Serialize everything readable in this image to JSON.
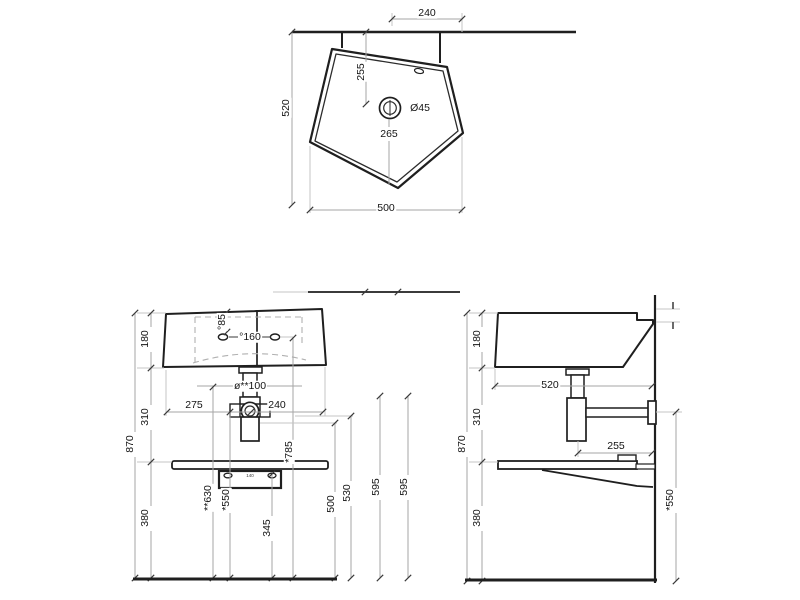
{
  "drawing": {
    "type": "washbasin installation drawing, three orthographic views"
  },
  "top_view": {
    "dims": {
      "offset_240": "240",
      "depth_520": "520",
      "drain_from_wall_255": "255",
      "drain_diameter": "Ø45",
      "drain_to_front_265": "265",
      "width_500": "500"
    }
  },
  "front_view": {
    "dims": {
      "basin_height_180": "180",
      "mid_height_310": "310",
      "overall_height_870": "870",
      "lower_height_380": "380",
      "hole_offset_85": "°85",
      "hole_spacing_160": "°160",
      "waste_dia_100": "ø**100",
      "left_275": "275",
      "right_240": "240",
      "holes_height_785": "*785",
      "waste_height_630": "**630",
      "trap_height_550": "*550",
      "bracket_height_345": "345",
      "conn_height_500": "500",
      "conn_height_530": "530",
      "supply_height_595_left": "595",
      "supply_height_595_right": "595",
      "bracket_holes_140": "140"
    }
  },
  "side_view": {
    "dims": {
      "basin_height_180": "180",
      "mid_height_310": "310",
      "overall_height_870": "870",
      "lower_height_380": "380",
      "depth_520": "520",
      "trap_to_wall_255": "255",
      "trap_height_550": "*550"
    }
  }
}
